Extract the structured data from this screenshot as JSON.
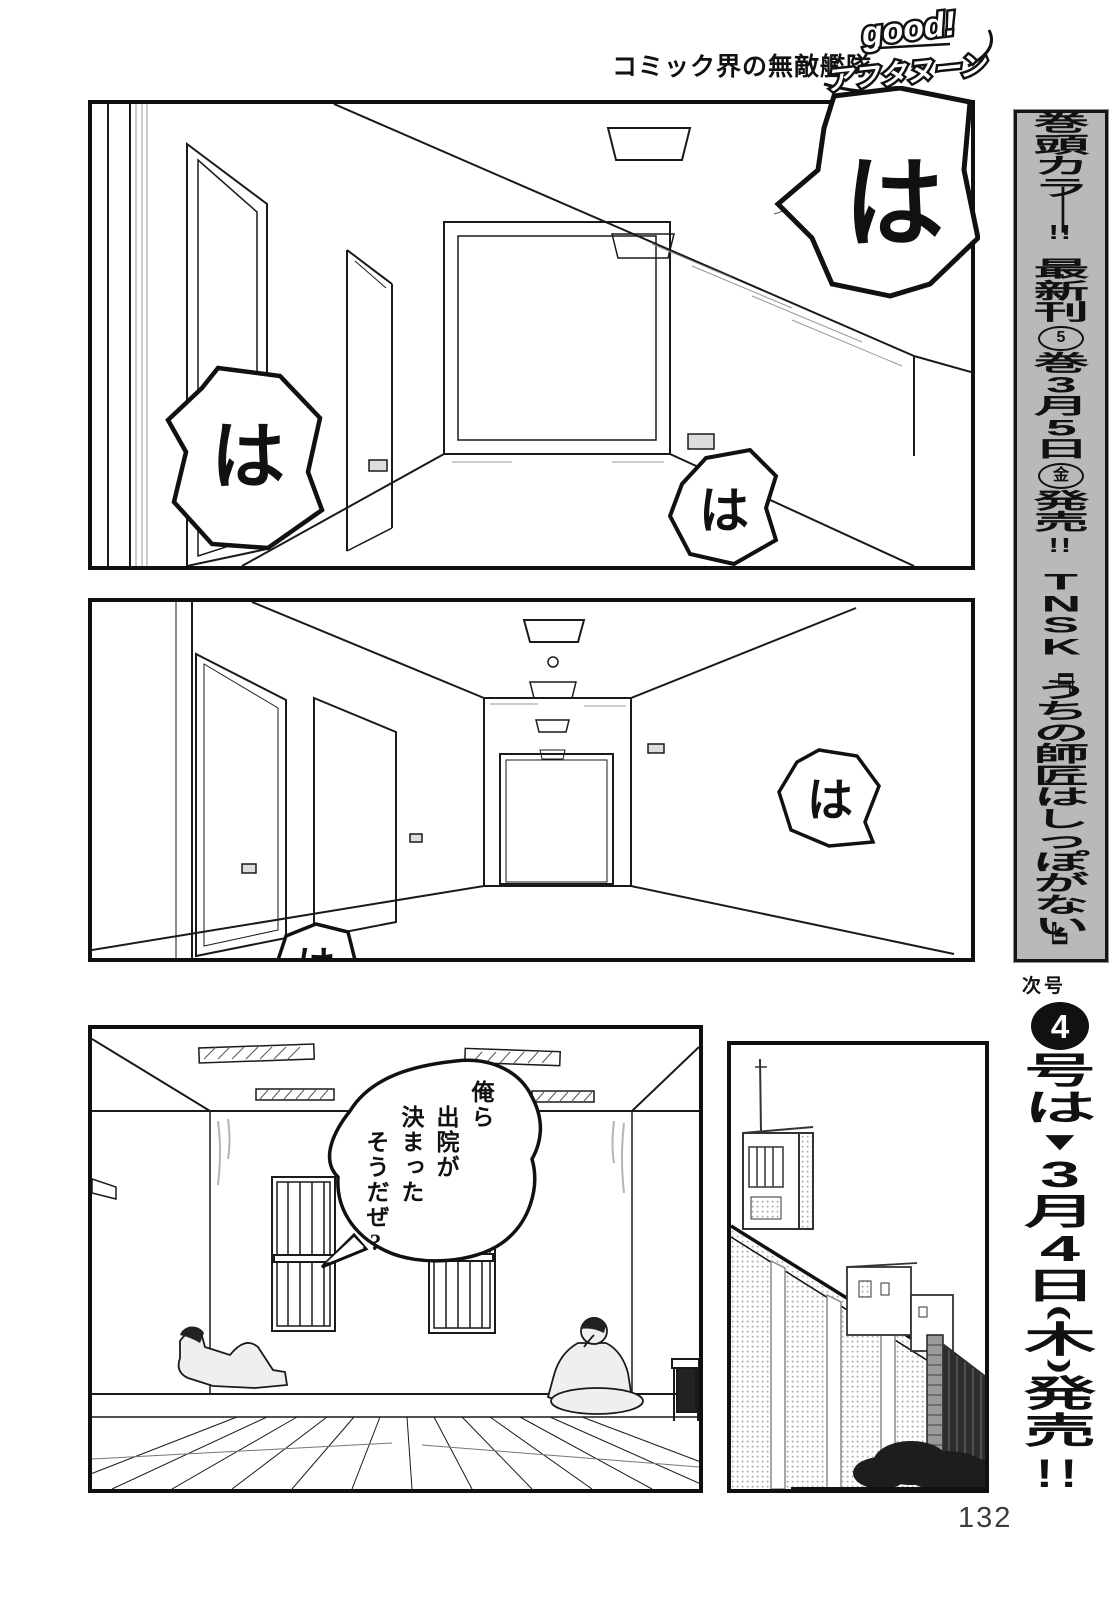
{
  "header": {
    "catchphrase": "コミック界の無敵艦隊",
    "magazine_logo": {
      "top": "good!",
      "bottom": "アフタヌーン"
    }
  },
  "sidebar": {
    "promo_banner": {
      "text": "巻頭カラー!! 最新刊⑤巻3月5日㊎発売!! TNSK『うちの師匠はしっぽがない』",
      "tokens": [
        {
          "t": "巻"
        },
        {
          "t": "頭"
        },
        {
          "t": "カ"
        },
        {
          "t": "ラ"
        },
        {
          "t": "ー",
          "s": "rot"
        },
        {
          "t": "!!",
          "s": "pair"
        },
        {
          "t": "",
          "s": "gap"
        },
        {
          "t": "最"
        },
        {
          "t": "新"
        },
        {
          "t": "刊"
        },
        {
          "t": "5",
          "s": "circle"
        },
        {
          "t": "巻"
        },
        {
          "t": "3"
        },
        {
          "t": "月"
        },
        {
          "t": "5"
        },
        {
          "t": "日"
        },
        {
          "t": "金",
          "s": "circle"
        },
        {
          "t": "発"
        },
        {
          "t": "売"
        },
        {
          "t": "!!",
          "s": "pair"
        },
        {
          "t": "",
          "s": "gap"
        },
        {
          "t": "T"
        },
        {
          "t": "N"
        },
        {
          "t": "S"
        },
        {
          "t": "K"
        },
        {
          "t": "『",
          "s": "rot"
        },
        {
          "t": "う"
        },
        {
          "t": "ち"
        },
        {
          "t": "の"
        },
        {
          "t": "師"
        },
        {
          "t": "匠"
        },
        {
          "t": "は"
        },
        {
          "t": "し"
        },
        {
          "t": "っ"
        },
        {
          "t": "ぽ"
        },
        {
          "t": "が"
        },
        {
          "t": "な"
        },
        {
          "t": "い"
        },
        {
          "t": "』",
          "s": "rot"
        }
      ]
    },
    "next_issue": {
      "label": "次号",
      "text": "4号は▼3月4日(木)発売!!",
      "tokens": [
        {
          "t": "4",
          "s": "circle-filled"
        },
        {
          "t": "号"
        },
        {
          "t": "は"
        },
        {
          "t": "▼",
          "s": "tri"
        },
        {
          "t": "3"
        },
        {
          "t": "月"
        },
        {
          "t": "4"
        },
        {
          "t": "日"
        },
        {
          "t": "(",
          "s": "rot"
        },
        {
          "t": "木"
        },
        {
          "t": ")",
          "s": "rot"
        },
        {
          "t": "発"
        },
        {
          "t": "売"
        },
        {
          "t": "!!",
          "s": "pair-big"
        }
      ]
    }
  },
  "panels": [
    {
      "id": "panel-1",
      "scene": "hospital corridor, corner view with large door",
      "sfx": [
        "は",
        "は",
        "は"
      ]
    },
    {
      "id": "panel-2",
      "scene": "hospital corridor, one-point perspective",
      "sfx": [
        "は",
        "は"
      ]
    },
    {
      "id": "panel-3",
      "scene": "room with barred windows, two seated men",
      "dialogue": {
        "lines": [
          "俺ら",
          "出院が",
          "決まった",
          "そうだぜ?"
        ]
      }
    },
    {
      "id": "panel-4",
      "scene": "exterior wall and buildings",
      "sfx": []
    }
  ],
  "page_number": "132",
  "colors": {
    "ink": "#111111",
    "paper": "#ffffff",
    "banner_bg": "#b9b9b9",
    "page_number": "#3d3d3d"
  }
}
